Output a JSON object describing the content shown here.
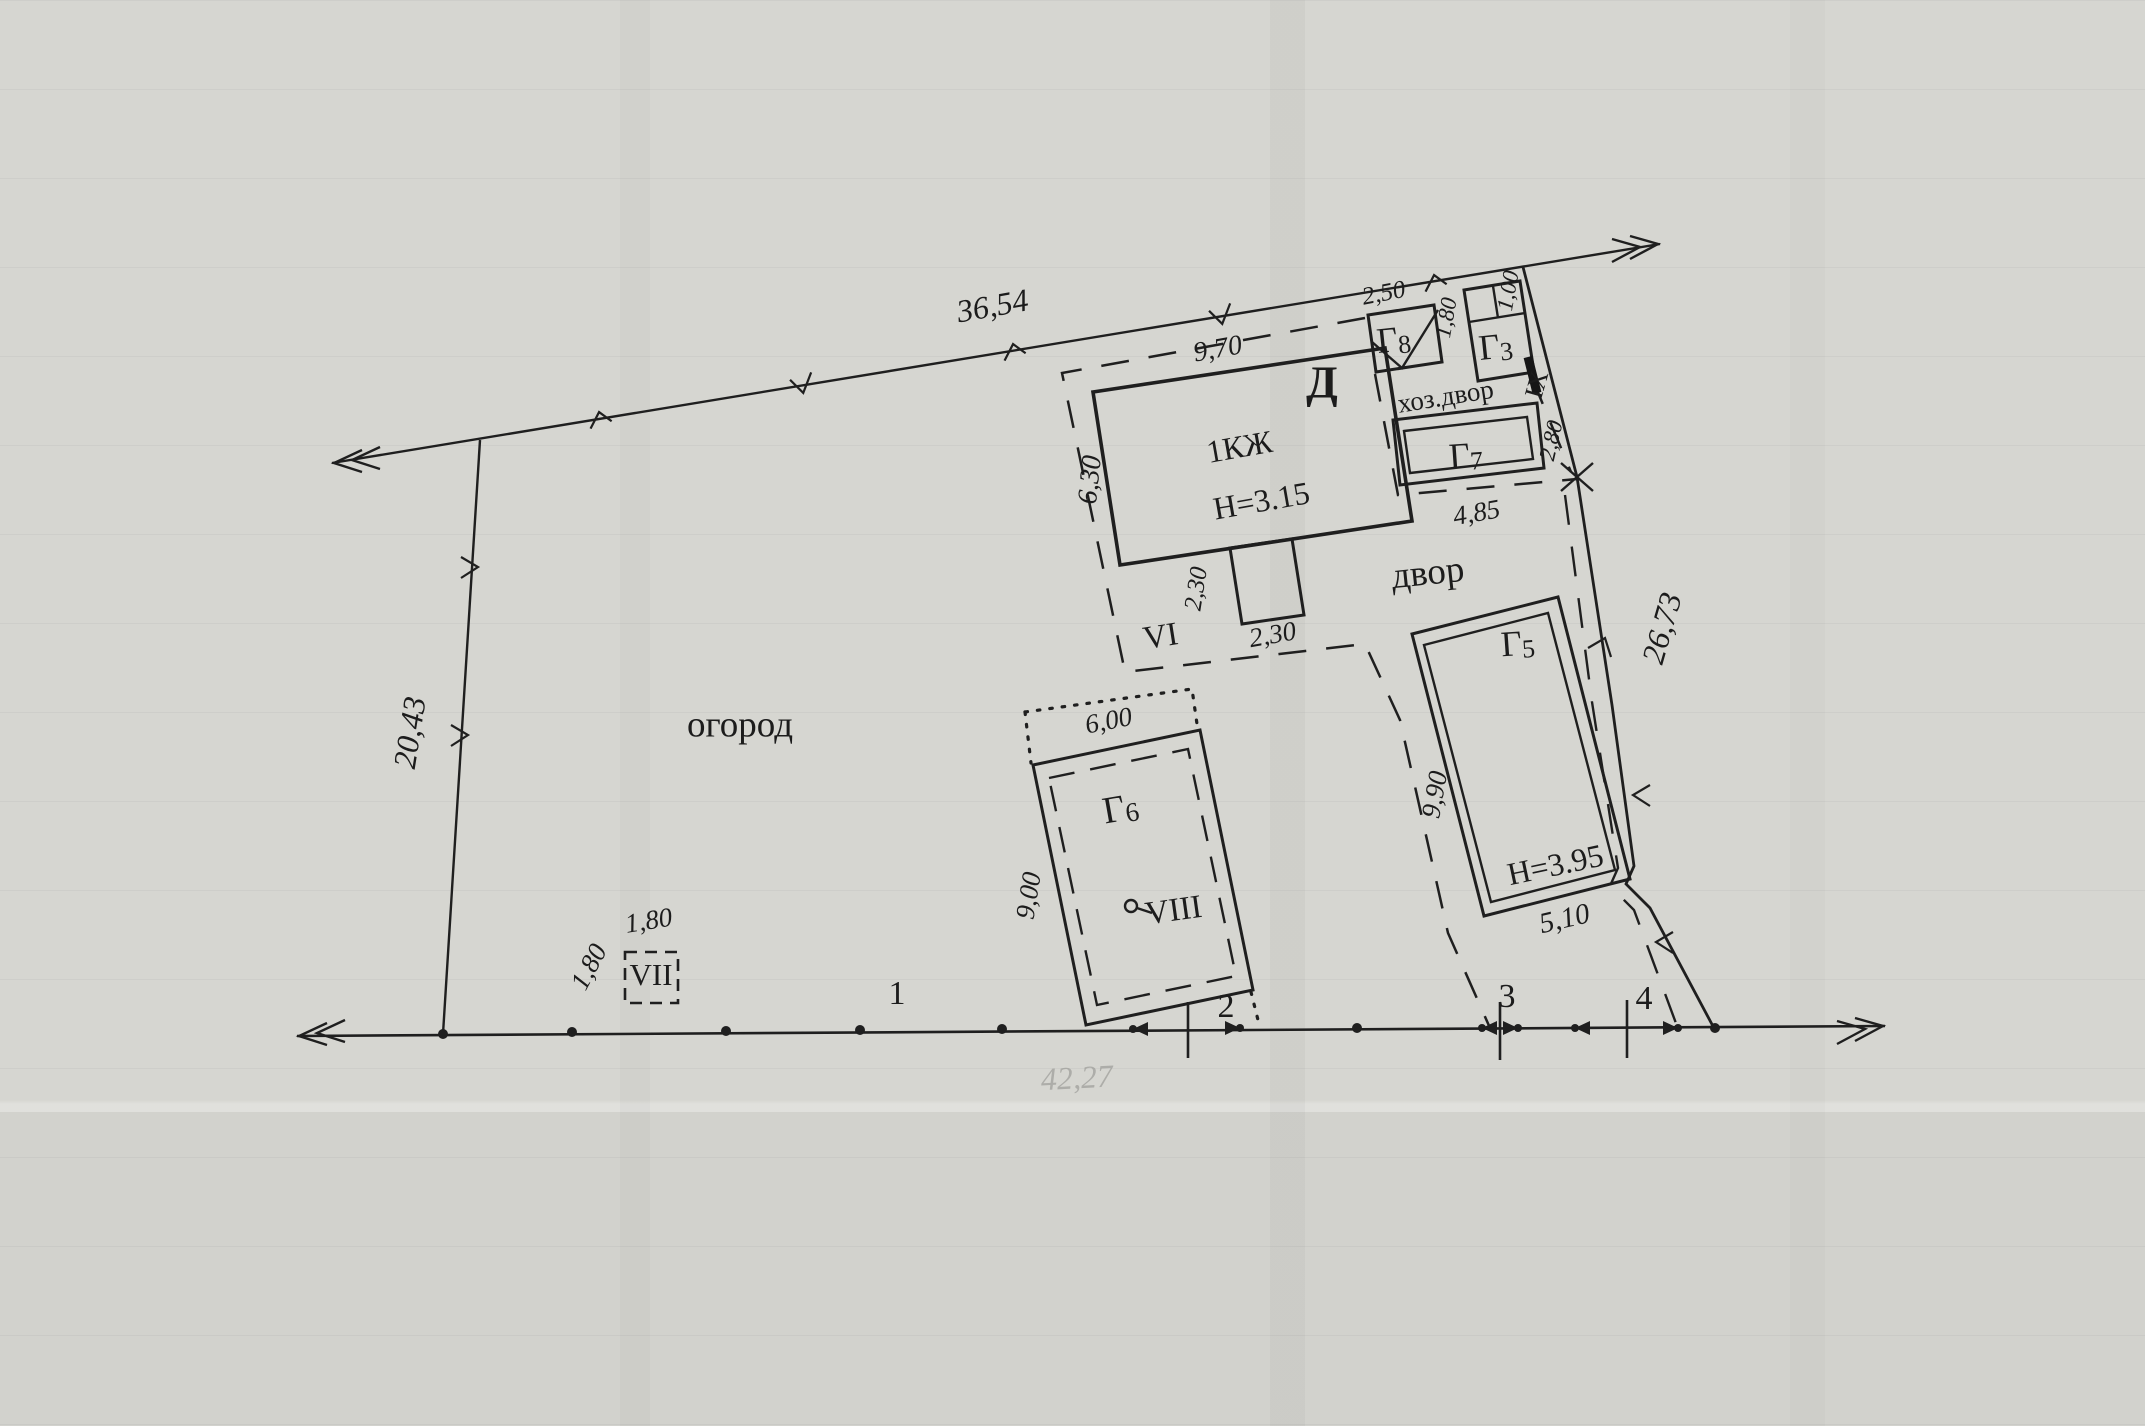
{
  "plan": {
    "areas": {
      "garden_label": "огород",
      "yard_label": "двор",
      "utility_yard_label": "хоз.двор"
    },
    "buildings": [
      {
        "name": "Д",
        "floors_note": "1КЖ",
        "height_note": "Н=3.15"
      },
      {
        "name": "Г8"
      },
      {
        "name": "Г3"
      },
      {
        "name": "Г7"
      },
      {
        "name": "Г5",
        "height_note": "Н=3.95"
      },
      {
        "name": "Г6"
      }
    ],
    "roman_marks": [
      "VI",
      "VII",
      "VIII",
      "IX"
    ],
    "survey_points": [
      "1",
      "2",
      "3",
      "4"
    ],
    "boundary_dimensions": [
      "36,54",
      "20,43",
      "26,73",
      "42,27"
    ],
    "detail_dimensions": [
      "9,70",
      "6,30",
      "2,50",
      "1,80",
      "1,00",
      "2,80",
      "4,85",
      "9,90",
      "5,10",
      "2,30",
      "2,30",
      "6,00",
      "9,00",
      "1,80",
      "1,80"
    ]
  },
  "labels": [
    {
      "id": "dim-36-54",
      "text": "36,54",
      "x": 993,
      "y": 309,
      "rot": -10,
      "size": 32,
      "cls": "dim"
    },
    {
      "id": "dim-20-43",
      "text": "20,43",
      "x": 413,
      "y": 733,
      "rot": -81,
      "size": 32,
      "cls": "dim"
    },
    {
      "id": "dim-26-73",
      "text": "26,73",
      "x": 1665,
      "y": 629,
      "rot": -74,
      "size": 32,
      "cls": "dim"
    },
    {
      "id": "dim-42-27",
      "text": "42,27",
      "x": 1077,
      "y": 1081,
      "rot": -3,
      "size": 32,
      "cls": "dim faded"
    },
    {
      "id": "dim-9-70",
      "text": "9,70",
      "x": 1218,
      "y": 351,
      "rot": -10,
      "size": 28,
      "cls": "dim"
    },
    {
      "id": "dim-6-30",
      "text": "6,30",
      "x": 1092,
      "y": 480,
      "rot": -84,
      "size": 28,
      "cls": "dim"
    },
    {
      "id": "dim-2-50",
      "text": "2,50",
      "x": 1384,
      "y": 295,
      "rot": -11,
      "size": 25,
      "cls": "dim"
    },
    {
      "id": "dim-1-80-a",
      "text": "1,80",
      "x": 1448,
      "y": 318,
      "rot": -80,
      "size": 23,
      "cls": "dim"
    },
    {
      "id": "dim-1-00",
      "text": "1,00",
      "x": 1510,
      "y": 291,
      "rot": -80,
      "size": 23,
      "cls": "dim"
    },
    {
      "id": "dim-2-80",
      "text": "2,80",
      "x": 1553,
      "y": 441,
      "rot": -77,
      "size": 23,
      "cls": "dim"
    },
    {
      "id": "dim-4-85",
      "text": "4,85",
      "x": 1477,
      "y": 515,
      "rot": -10,
      "size": 27,
      "cls": "dim"
    },
    {
      "id": "dim-9-90",
      "text": "9,90",
      "x": 1437,
      "y": 795,
      "rot": -80,
      "size": 27,
      "cls": "dim"
    },
    {
      "id": "dim-5-10",
      "text": "5,10",
      "x": 1565,
      "y": 921,
      "rot": -13,
      "size": 29,
      "cls": "dim"
    },
    {
      "id": "dim-2-30-v",
      "text": "2,30",
      "x": 1198,
      "y": 589,
      "rot": -81,
      "size": 25,
      "cls": "dim"
    },
    {
      "id": "dim-2-30-h",
      "text": "2,30",
      "x": 1273,
      "y": 637,
      "rot": -10,
      "size": 27,
      "cls": "dim"
    },
    {
      "id": "dim-6-00",
      "text": "6,00",
      "x": 1109,
      "y": 723,
      "rot": -11,
      "size": 27,
      "cls": "dim"
    },
    {
      "id": "dim-9-00",
      "text": "9,00",
      "x": 1031,
      "y": 896,
      "rot": -81,
      "size": 27,
      "cls": "dim"
    },
    {
      "id": "dim-1-80-b",
      "text": "1,80",
      "x": 649,
      "y": 923,
      "rot": -9,
      "size": 27,
      "cls": "dim"
    },
    {
      "id": "dim-1-80-c",
      "text": "1,80",
      "x": 591,
      "y": 968,
      "rot": -62,
      "size": 27,
      "cls": "dim"
    },
    {
      "id": "building-label-d",
      "text": "Д",
      "x": 1322,
      "y": 387,
      "rot": 0,
      "size": 46,
      "cls": "big"
    },
    {
      "id": "building-note-1kzh",
      "text": "1КЖ",
      "x": 1240,
      "y": 450,
      "rot": -10,
      "size": 32
    },
    {
      "id": "building-note-h315",
      "text": "Н=3.15",
      "x": 1262,
      "y": 504,
      "rot": -10,
      "size": 32
    },
    {
      "id": "building-note-h395",
      "text": "Н=3.95",
      "x": 1556,
      "y": 868,
      "rot": -12,
      "size": 32
    },
    {
      "id": "building-label-g8",
      "text": "Г",
      "sub": "8",
      "x": 1394,
      "y": 343,
      "rot": -6,
      "size": 36
    },
    {
      "id": "building-label-g3",
      "text": "Г",
      "sub": "3",
      "x": 1496,
      "y": 350,
      "rot": -6,
      "size": 36
    },
    {
      "id": "building-label-g7",
      "text": "Г",
      "sub": "7",
      "x": 1466,
      "y": 459,
      "rot": -4,
      "size": 36
    },
    {
      "id": "building-label-g5",
      "text": "Г",
      "sub": "5",
      "x": 1518,
      "y": 647,
      "rot": -4,
      "size": 36
    },
    {
      "id": "building-label-g6",
      "text": "Г",
      "sub": "6",
      "x": 1121,
      "y": 812,
      "rot": -10,
      "size": 38
    },
    {
      "id": "area-label-ogorod",
      "text": "огород",
      "x": 740,
      "y": 728,
      "rot": 0,
      "size": 37
    },
    {
      "id": "area-label-dvor",
      "text": "двор",
      "x": 1428,
      "y": 576,
      "rot": -6,
      "size": 37
    },
    {
      "id": "area-label-hozdvor",
      "text": "хоз.двор",
      "x": 1446,
      "y": 399,
      "rot": -9,
      "size": 27
    },
    {
      "id": "roman-vi",
      "text": "VI",
      "x": 1161,
      "y": 639,
      "rot": -9,
      "size": 33
    },
    {
      "id": "roman-vii",
      "text": "VII",
      "x": 651,
      "y": 978,
      "rot": 0,
      "size": 31
    },
    {
      "id": "roman-viii",
      "text": "VIII",
      "x": 1174,
      "y": 913,
      "rot": -8,
      "size": 33
    },
    {
      "id": "roman-ix",
      "text": "IX",
      "x": 1539,
      "y": 385,
      "rot": -74,
      "size": 26
    },
    {
      "id": "point-label-1",
      "text": "1",
      "x": 897,
      "y": 996,
      "rot": 0,
      "size": 34
    },
    {
      "id": "point-label-2",
      "text": "2",
      "x": 1226,
      "y": 1009,
      "rot": 0,
      "size": 34
    },
    {
      "id": "point-label-3",
      "text": "3",
      "x": 1507,
      "y": 999,
      "rot": 0,
      "size": 34
    },
    {
      "id": "point-label-4",
      "text": "4",
      "x": 1644,
      "y": 1001,
      "rot": 0,
      "size": 34
    }
  ]
}
